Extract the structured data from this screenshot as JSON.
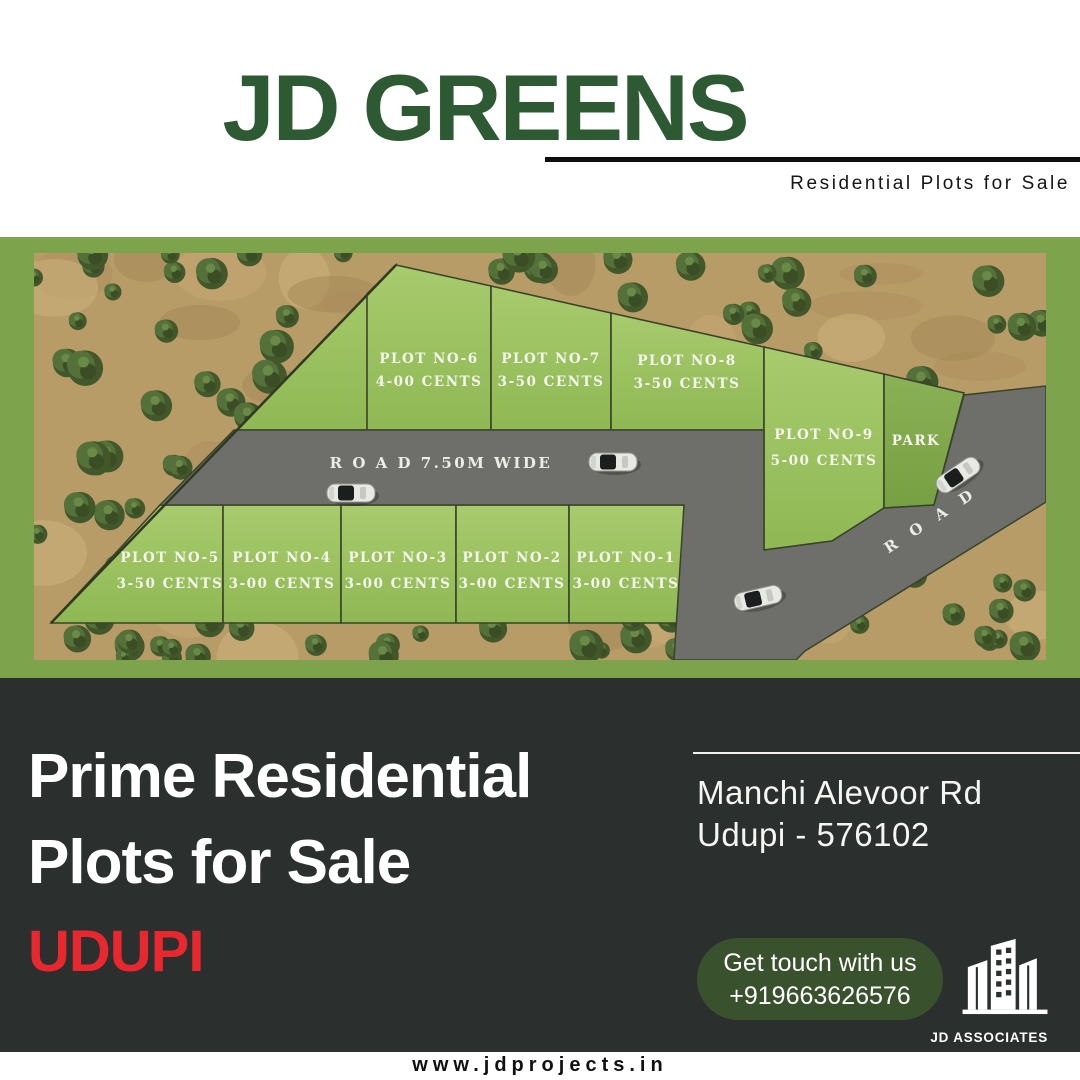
{
  "header": {
    "title": "JD GREENS",
    "subtitle": "Residential Plots for Sale"
  },
  "site_plan": {
    "road_label": "R O A D  7.50M  WIDE",
    "diagonal_road_label": "R O A D",
    "park_label": "PARK",
    "plots": [
      {
        "id": "plot-1",
        "name": "PLOT NO-1",
        "area": "3-00 CENTS"
      },
      {
        "id": "plot-2",
        "name": "PLOT NO-2",
        "area": "3-00 CENTS"
      },
      {
        "id": "plot-3",
        "name": "PLOT NO-3",
        "area": "3-00 CENTS"
      },
      {
        "id": "plot-4",
        "name": "PLOT NO-4",
        "area": "3-00 CENTS"
      },
      {
        "id": "plot-5",
        "name": "PLOT NO-5",
        "area": "3-50 CENTS"
      },
      {
        "id": "plot-6",
        "name": "PLOT NO-6",
        "area": "4-00 CENTS"
      },
      {
        "id": "plot-7",
        "name": "PLOT NO-7",
        "area": "3-50 CENTS"
      },
      {
        "id": "plot-8",
        "name": "PLOT NO-8",
        "area": "3-50 CENTS"
      },
      {
        "id": "plot-9",
        "name": "PLOT NO-9",
        "area": "5-00 CENTS"
      }
    ]
  },
  "promo": {
    "headline_line1": "Prime Residential",
    "headline_line2": "Plots for Sale",
    "city": "UDUPI",
    "address_line1": "Manchi Alevoor Rd",
    "address_line2": "Udupi - 576102",
    "contact_button": {
      "line1": "Get touch with us",
      "line2": "+919663626576"
    },
    "brand": {
      "name": "JD ASSOCIATES"
    }
  },
  "footer": {
    "website": "www.jdprojects.in"
  },
  "colors": {
    "title_green": "#2d5a33",
    "frame_green": "#7da44c",
    "plot_green": "#9dc162",
    "park_green": "#85ab4f",
    "road_gray": "#6e6f6b",
    "terrain_tan": "#b89c68",
    "dark_bg": "#2b2f2e",
    "accent_red": "#e8282e",
    "button_green": "#3a512e"
  }
}
